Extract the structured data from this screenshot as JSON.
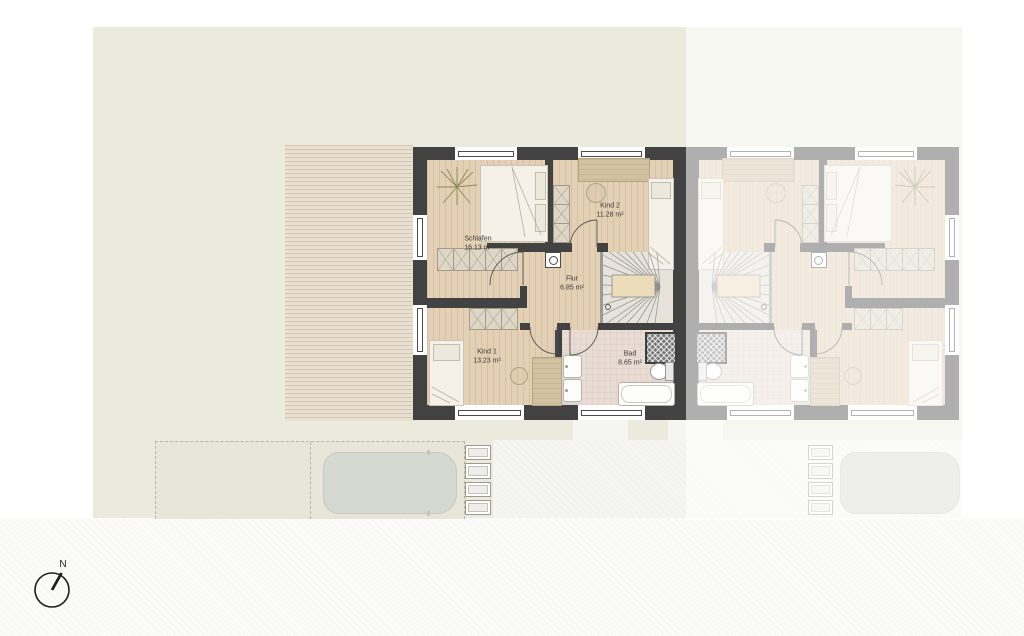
{
  "site": {
    "compass_label": "N",
    "rooms": [
      {
        "name": "Schlafen",
        "area": "16.13 m²"
      },
      {
        "name": "Kind 2",
        "area": "11.28 m²"
      },
      {
        "name": "Flur",
        "area": "6.85 m²"
      },
      {
        "name": "Kind 1",
        "area": "13.23 m²"
      },
      {
        "name": "Bad",
        "area": "8.65 m²"
      }
    ]
  },
  "colors": {
    "garden": "#ebebdd",
    "terrace": "#e9dfd0",
    "wall": "#424242",
    "wood": "#e4d0b5",
    "bad-floor": "#e9dcd5",
    "stair-floor": "#e7e3da",
    "street": "#fbfbf9",
    "pavement": "#f5f5f2",
    "driveway": "#e7e6d9",
    "car": "#d6d8d2",
    "ink": "#1e1e1e"
  }
}
